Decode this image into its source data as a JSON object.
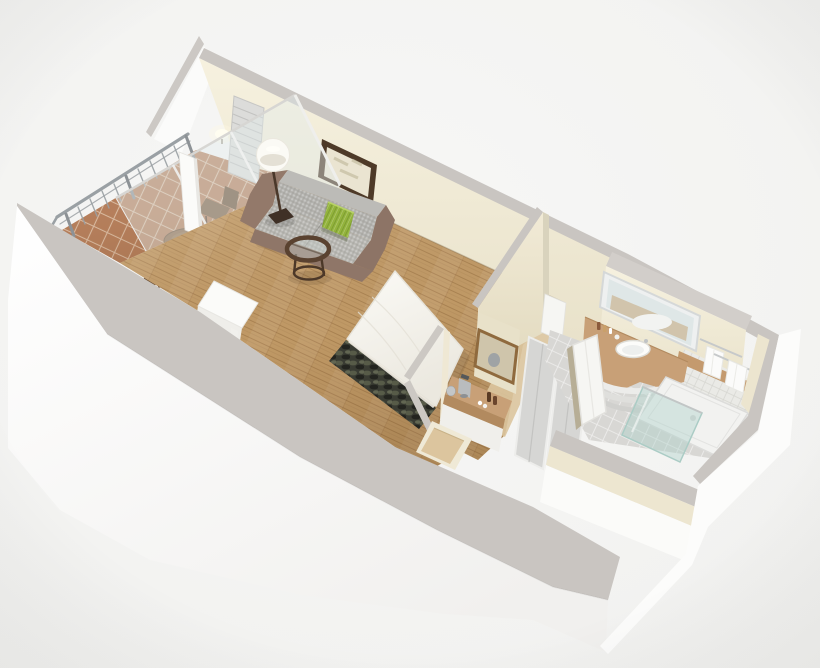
{
  "scene": {
    "aria_label": "3D isometric rendering of a studio hotel suite floor plan with corner balcony, combined living and sleeping area, kitchenette nook, closet, entry and bathroom",
    "rooms": [
      "balcony",
      "living-sleeping-area",
      "kitchenette-nook",
      "entry-hall",
      "closet",
      "bathroom"
    ],
    "furniture": [
      "balcony-dining-table",
      "balcony-chairs",
      "balcony-railing",
      "sliding-glass-door",
      "louver-panel",
      "floor-lamp",
      "framed-picture",
      "wall-sconce",
      "sofa",
      "green-accent-pillow",
      "round-coffee-table",
      "white-console-table",
      "double-bed",
      "dark-bed-runner",
      "kitchenette-counter",
      "coffee-maker",
      "gold-framed-mirror",
      "sliding-closet-doors",
      "vanity-mirror",
      "curved-vanity-counter",
      "oval-sink",
      "towel-rack",
      "walk-in-shower",
      "glass-shower-panel"
    ]
  },
  "palette": {
    "background": "#f4f4f3",
    "wall_top_gray": "#c9c5c1",
    "wall_jog_gray": "#d2ceca",
    "outer_wall_white": "#fcfcfb",
    "wood_floor": "#c39d69",
    "hall_floor": "#dcc59e",
    "terracotta": "#b8835f",
    "bath_floor_tile": "#d8d7d4",
    "wall_tile": "#eaeae6",
    "counter_tan": "#c8a077",
    "sofa_gray": "#b2b1ad",
    "sofa_frame_taupe": "#8f7668",
    "pillow_green": "#93b33c",
    "runner_dark": "#3a3c33",
    "dining_wood": "#8a6747",
    "coffee_table_wood": "#5a4230",
    "picture_frame_brown": "#4e3a28",
    "gold_mirror_frame": "#8f6a3e",
    "railing_metal": "#9aa0a4",
    "glass_tint": "rgba(226,236,236,0.42)",
    "shower_glass": "rgba(170,208,200,0.40)",
    "towel_white": "#fbfbfa",
    "lamp_shade": "#fbfaf5",
    "lamp_pole": "#4a382a",
    "closet_door_gray": "#d6d6d4",
    "ledge_wood": "#c49a6e",
    "sconce_glow": "#fffdf0"
  }
}
